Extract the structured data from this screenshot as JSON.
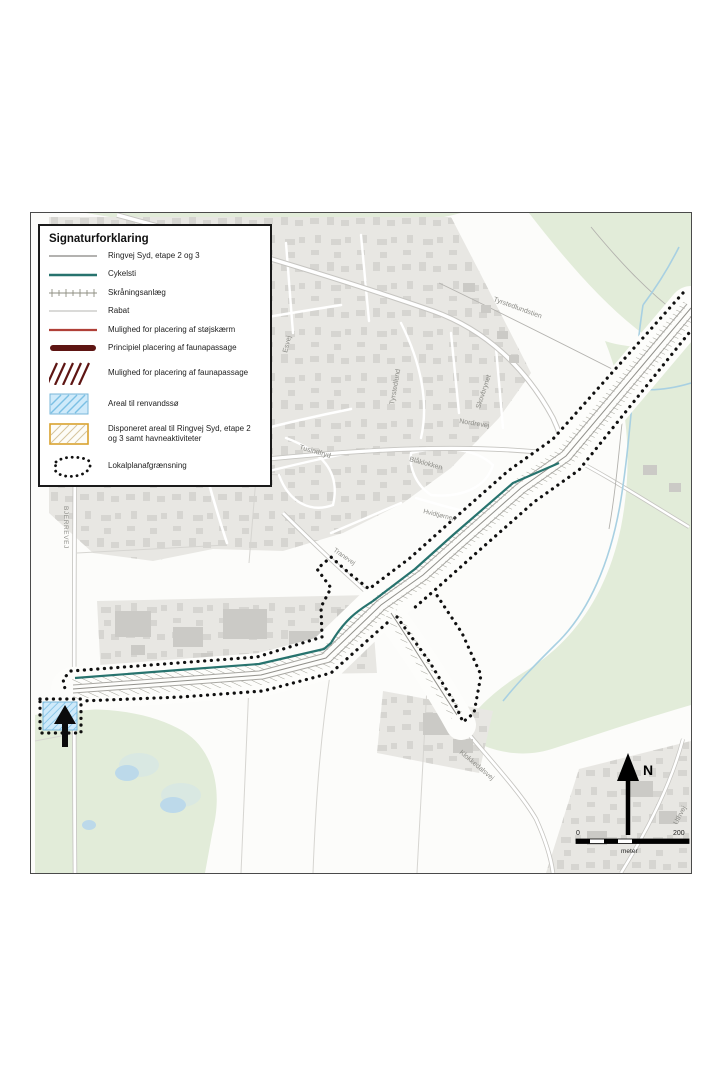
{
  "legend": {
    "title": "Signaturforklaring",
    "items": [
      {
        "label": "Ringvej Syd, etape 2 og 3",
        "swatch": "line-gray"
      },
      {
        "label": "Cykelsti",
        "swatch": "line-teal"
      },
      {
        "label": "Skråningsanlæg",
        "swatch": "line-ticks"
      },
      {
        "label": "Rabat",
        "swatch": "line-thin-gray"
      },
      {
        "label": "Mulighed for placering af støjskærm",
        "swatch": "line-red"
      },
      {
        "label": "Principiel placering af faunapassage",
        "swatch": "line-maroon-thick"
      },
      {
        "label": "Mulighed for placering af faunapassage",
        "swatch": "hatch-maroon"
      },
      {
        "label": "Areal til renvandssø",
        "swatch": "area-blue-hatch"
      },
      {
        "label": "Disponeret areal til Ringvej Syd, etape 2 og 3 samt havneaktiviteter",
        "swatch": "area-orange-hatch"
      },
      {
        "label": "Lokalplanafgrænsning",
        "swatch": "dotted-boundary"
      }
    ]
  },
  "map": {
    "street_labels": [
      {
        "id": "bjerrevej",
        "text": "BJERREVEJ"
      },
      {
        "id": "esvej",
        "text": "Esvej"
      },
      {
        "id": "tyrstedlund",
        "text": "Tyrstedlund"
      },
      {
        "id": "skovbrynet",
        "text": "Skovbrynet"
      },
      {
        "id": "tyrstedlundstien",
        "text": "Tyrstedlundstien"
      },
      {
        "id": "nordrevej",
        "text": "Nordrevej"
      },
      {
        "id": "tusindfryd",
        "text": "Tusindfryd"
      },
      {
        "id": "blaaklokken",
        "text": "Blåklokken"
      },
      {
        "id": "hvidtjornen",
        "text": "Hvidtjørnen"
      },
      {
        "id": "tranevej",
        "text": "Tranevej"
      },
      {
        "id": "klokkedalsvej",
        "text": "Klokkedalsvej"
      },
      {
        "id": "uthvej",
        "text": "Uthvej"
      }
    ],
    "north_label": "N",
    "scale": {
      "start": "0",
      "end": "200",
      "unit": "meter"
    }
  },
  "colors": {
    "teal": "#27736e",
    "red": "#b04038",
    "maroon": "#5e1513",
    "blue-fill": "#cfeafa",
    "blue-border": "#79b7d9",
    "orange-border": "#d9a22e",
    "boundary-black": "#101010"
  }
}
